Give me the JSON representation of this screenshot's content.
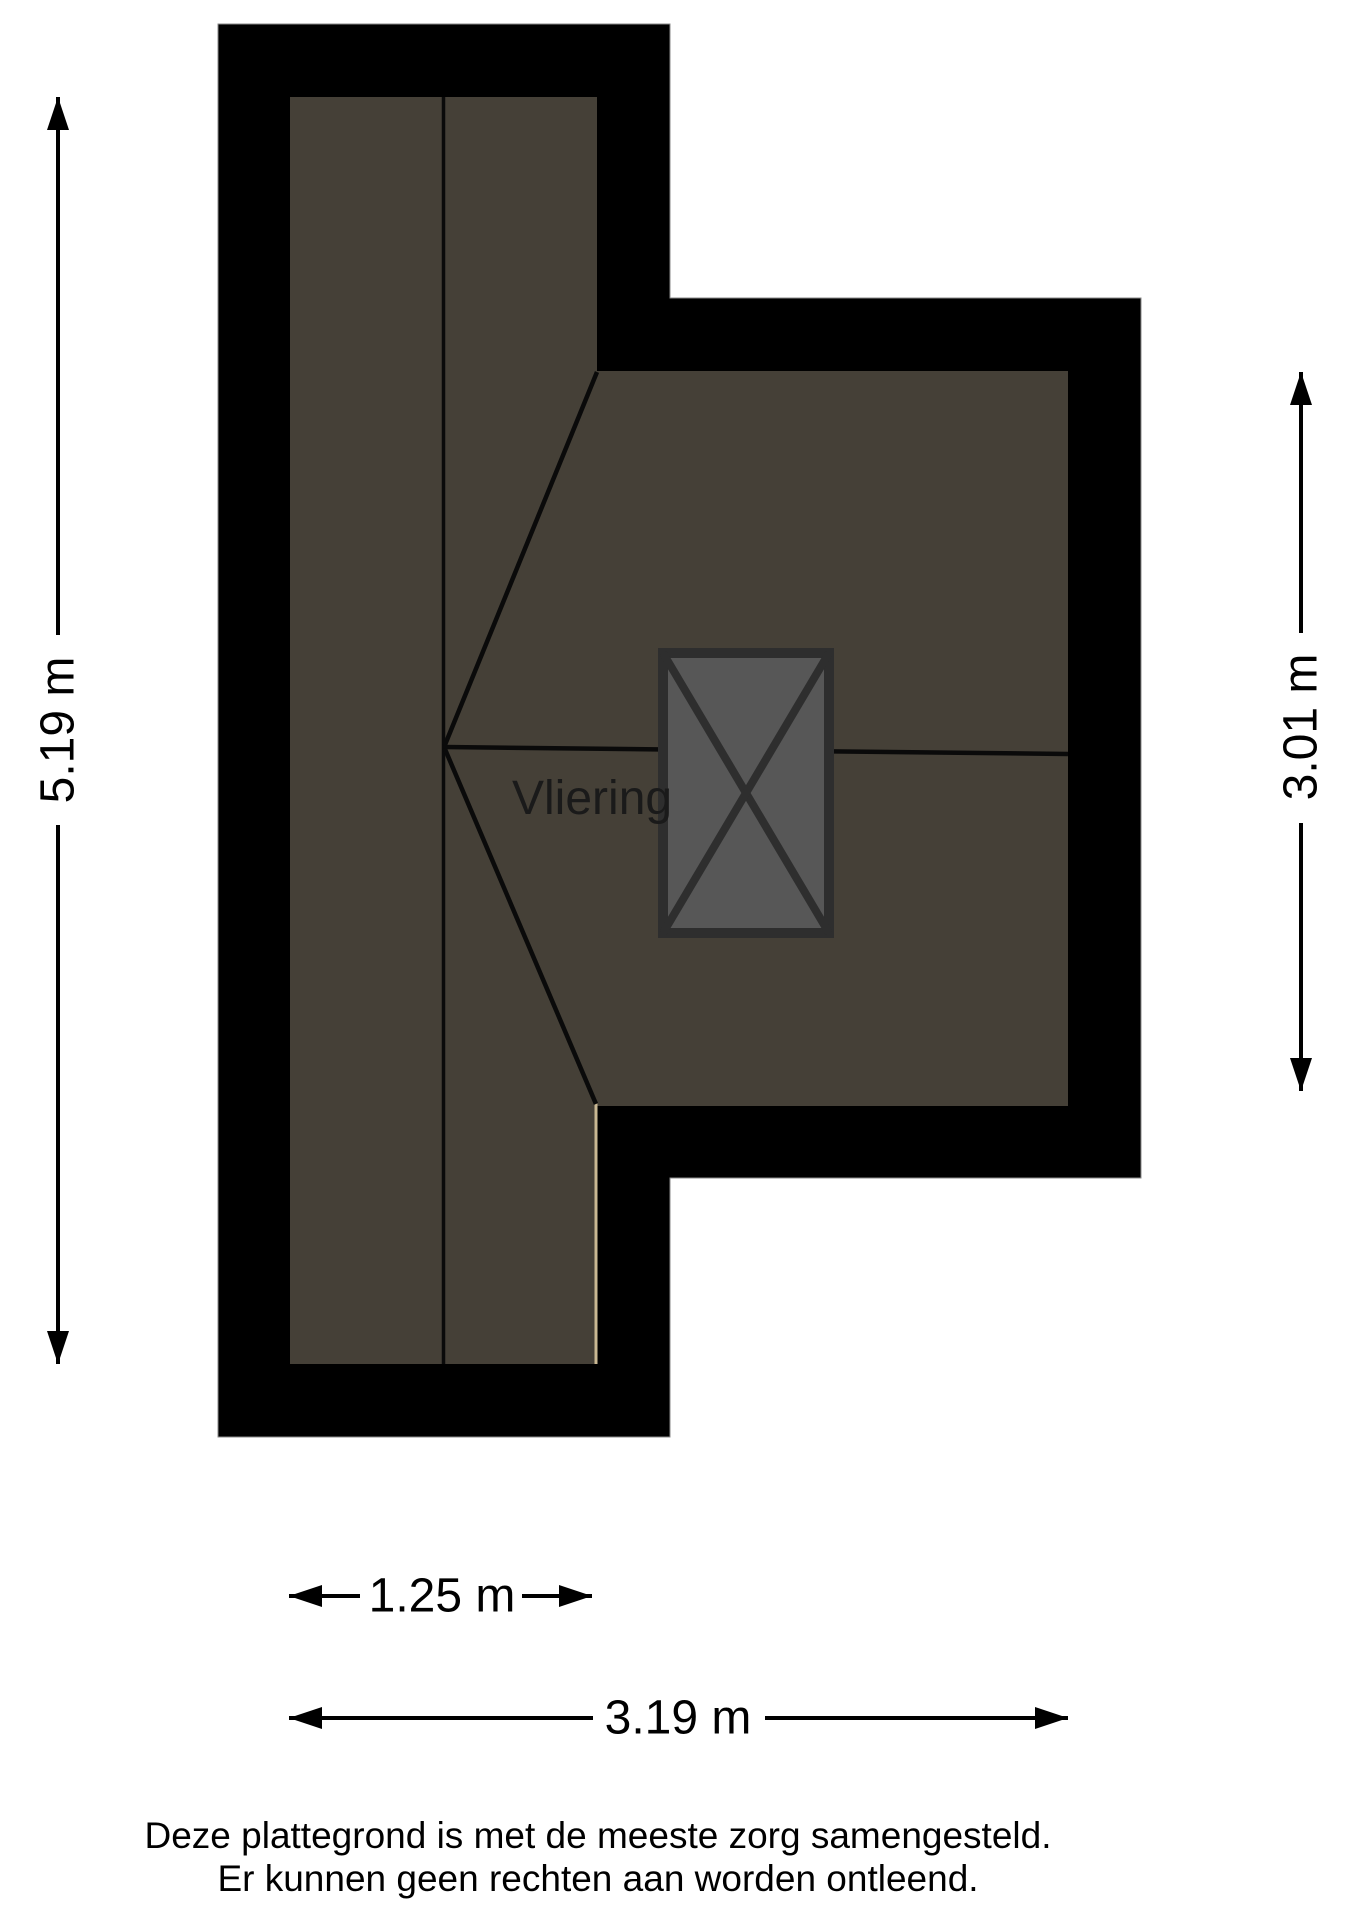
{
  "plan": {
    "room_label": "Vliering"
  },
  "dimensions": {
    "left_height": "5.19 m",
    "right_height": "3.01 m",
    "bottom_small_width": "1.25 m",
    "bottom_large_width": "3.19 m"
  },
  "footer": {
    "line1": "Deze plattegrond is met de meeste zorg samengesteld.",
    "line2": "Er kunnen geen rechten aan worden ontleend."
  },
  "colors": {
    "wall": "#000000",
    "floor": "#454037",
    "box-fill": "#575757",
    "box-line": "#2e2e2e",
    "plan-line": "#0a0a0a",
    "tan": "#c9b893",
    "ink": "#000000",
    "page-bg": "#ffffff"
  }
}
